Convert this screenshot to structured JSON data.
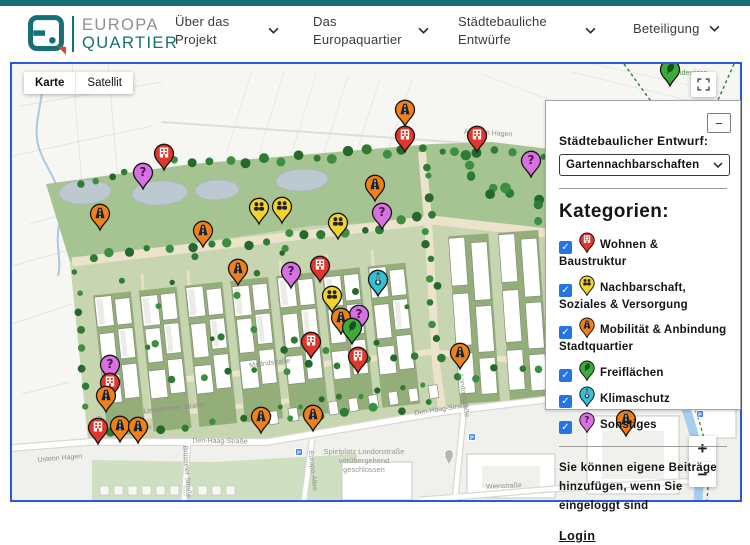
{
  "header": {
    "brand_top": "EUROPA",
    "brand_bottom": "QUARTIER",
    "nav": [
      {
        "label": "Über das Projekt"
      },
      {
        "label": "Das Europaquartier"
      },
      {
        "label": "Städtebauliche Entwürfe"
      },
      {
        "label": "Beteiligung"
      }
    ]
  },
  "map_controls": {
    "map_type": [
      "Karte",
      "Satellit"
    ],
    "selected_map_type": "Karte",
    "zoom_in": "+",
    "zoom_out": "−",
    "collapse": "−"
  },
  "panel": {
    "entwurf_label": "Städtebaulicher Entwurf:",
    "entwurf_value": "Gartennachbarschaften",
    "kategorien_title": "Kategorien:",
    "categories": [
      {
        "key": "wohnen",
        "label": "Wohnen & Baustruktur",
        "color": "#e2362a",
        "checked": true
      },
      {
        "key": "nachbarschaft",
        "label": "Nachbarschaft, Soziales & Versorgung",
        "color": "#f2d22e",
        "checked": true
      },
      {
        "key": "mobilitaet",
        "label": "Mobilität & Anbindung Stadtquartier",
        "color": "#f28018",
        "checked": true
      },
      {
        "key": "freiflaechen",
        "label": "Freiflächen",
        "color": "#3faa3c",
        "checked": true
      },
      {
        "key": "klimaschutz",
        "label": "Klimaschutz",
        "color": "#32c0d4",
        "checked": true
      },
      {
        "key": "sonstiges",
        "label": "Sonstiges",
        "color": "#d770e0",
        "checked": true
      }
    ],
    "note": "Sie können eigene Beiträge hinzufügen, wenn Sie eingeloggt sind",
    "login_label": "Login",
    "checkmark": "✓"
  },
  "map": {
    "markers": [
      {
        "cat": "freiflaechen",
        "x": 658,
        "y": 22
      },
      {
        "cat": "mobilitaet",
        "x": 393,
        "y": 62
      },
      {
        "cat": "wohnen",
        "x": 393,
        "y": 88
      },
      {
        "cat": "wohnen",
        "x": 465,
        "y": 88
      },
      {
        "cat": "wohnen",
        "x": 152,
        "y": 106
      },
      {
        "cat": "sonstiges",
        "x": 519,
        "y": 113
      },
      {
        "cat": "sonstiges",
        "x": 131,
        "y": 125
      },
      {
        "cat": "mobilitaet",
        "x": 363,
        "y": 137
      },
      {
        "cat": "nachbarschaft",
        "x": 270,
        "y": 159
      },
      {
        "cat": "nachbarschaft",
        "x": 247,
        "y": 160
      },
      {
        "cat": "sonstiges",
        "x": 370,
        "y": 165
      },
      {
        "cat": "mobilitaet",
        "x": 88,
        "y": 166
      },
      {
        "cat": "nachbarschaft",
        "x": 326,
        "y": 175
      },
      {
        "cat": "mobilitaet",
        "x": 191,
        "y": 183
      },
      {
        "cat": "wohnen",
        "x": 308,
        "y": 218
      },
      {
        "cat": "mobilitaet",
        "x": 226,
        "y": 221
      },
      {
        "cat": "sonstiges",
        "x": 279,
        "y": 224
      },
      {
        "cat": "klimaschutz",
        "x": 366,
        "y": 232
      },
      {
        "cat": "nachbarschaft",
        "x": 320,
        "y": 248
      },
      {
        "cat": "sonstiges",
        "x": 347,
        "y": 267
      },
      {
        "cat": "mobilitaet",
        "x": 329,
        "y": 270
      },
      {
        "cat": "freiflaechen",
        "x": 340,
        "y": 280
      },
      {
        "cat": "wohnen",
        "x": 299,
        "y": 294
      },
      {
        "cat": "mobilitaet",
        "x": 448,
        "y": 305
      },
      {
        "cat": "wohnen",
        "x": 346,
        "y": 309
      },
      {
        "cat": "sonstiges",
        "x": 98,
        "y": 317
      },
      {
        "cat": "wohnen",
        "x": 98,
        "y": 335
      },
      {
        "cat": "mobilitaet",
        "x": 94,
        "y": 348
      },
      {
        "cat": "mobilitaet",
        "x": 301,
        "y": 367
      },
      {
        "cat": "mobilitaet",
        "x": 249,
        "y": 369
      },
      {
        "cat": "mobilitaet",
        "x": 614,
        "y": 372
      },
      {
        "cat": "mobilitaet",
        "x": 108,
        "y": 378
      },
      {
        "cat": "mobilitaet",
        "x": 126,
        "y": 379
      },
      {
        "cat": "wohnen",
        "x": 86,
        "y": 380
      }
    ],
    "street_labels": [
      {
        "text": "Auf dem Hagen",
        "x": 476,
        "y": 71,
        "rot": 3,
        "green": false
      },
      {
        "text": "Hundewiese",
        "x": 676,
        "y": 11,
        "rot": 0,
        "green": true
      },
      {
        "text": "Madridstraße",
        "x": 258,
        "y": 301,
        "rot": -7,
        "green": false
      },
      {
        "text": "Lissabonner Straße",
        "x": 162,
        "y": 346,
        "rot": -6,
        "green": false
      },
      {
        "text": "Den-Haag-Straße",
        "x": 112,
        "y": 361,
        "rot": 9,
        "green": false
      },
      {
        "text": "Den-Haag-Straße",
        "x": 208,
        "y": 379,
        "rot": 1,
        "green": false
      },
      {
        "text": "Den-Haag-Straße",
        "x": 430,
        "y": 347,
        "rot": -9,
        "green": false
      },
      {
        "text": "Brüsseler Straße",
        "x": 173,
        "y": 408,
        "rot": 86,
        "green": false
      },
      {
        "text": "Europa-Allee",
        "x": 299,
        "y": 407,
        "rot": 84,
        "green": false
      },
      {
        "text": "Londonstraße",
        "x": 450,
        "y": 332,
        "rot": 82,
        "green": false
      },
      {
        "text": "Wienstraße",
        "x": 492,
        "y": 424,
        "rot": -3,
        "green": false
      },
      {
        "text": "Ustenn Hagen",
        "x": 48,
        "y": 396,
        "rot": -5,
        "green": false
      }
    ],
    "place_note": {
      "lines": [
        "Spielplatz Londonstraße",
        "vorübergehend",
        "geschlossen"
      ]
    },
    "parking_glyph": "P",
    "parking": [
      {
        "x": 287,
        "y": 388
      },
      {
        "x": 460,
        "y": 373
      },
      {
        "x": 688,
        "y": 350
      }
    ]
  }
}
